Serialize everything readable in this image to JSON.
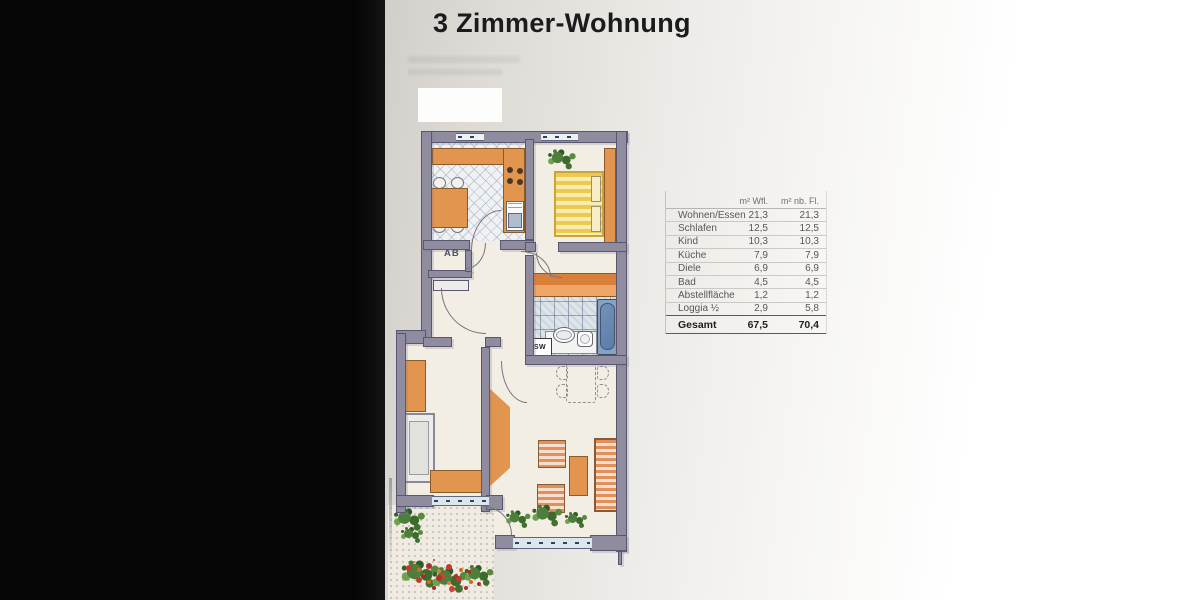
{
  "page": {
    "title": "3 Zimmer-Wohnung"
  },
  "table": {
    "col_headers": [
      "m² Wfl.",
      "m² nb. Fl."
    ],
    "rows": [
      [
        "Wohnen/Essen",
        "21,3",
        "21,3"
      ],
      [
        "Schlafen",
        "12,5",
        "12,5"
      ],
      [
        "Kind",
        "10,3",
        "10,3"
      ],
      [
        "Küche",
        "7,9",
        "7,9"
      ],
      [
        "Diele",
        "6,9",
        "6,9"
      ],
      [
        "Bad",
        "4,5",
        "4,5"
      ],
      [
        "Abstellfläche",
        "1,2",
        "1,2"
      ],
      [
        "Loggia ½",
        "2,9",
        "5,8"
      ]
    ],
    "total": [
      "Gesamt",
      "67,5",
      "70,4"
    ]
  },
  "plan": {
    "room_labels": {
      "storage": "AB",
      "washing_machine": "SW"
    }
  },
  "colors": {
    "wall": "#908ca0",
    "wall_outline": "#5a5670",
    "furniture_orange": "#e2954f",
    "bed_yellow": "#edc952",
    "tub_blue": "#5a7da9",
    "window_band": "#dbe7ec",
    "plant_green": "#4e7e3c",
    "flower_red": "#c23b2a"
  }
}
